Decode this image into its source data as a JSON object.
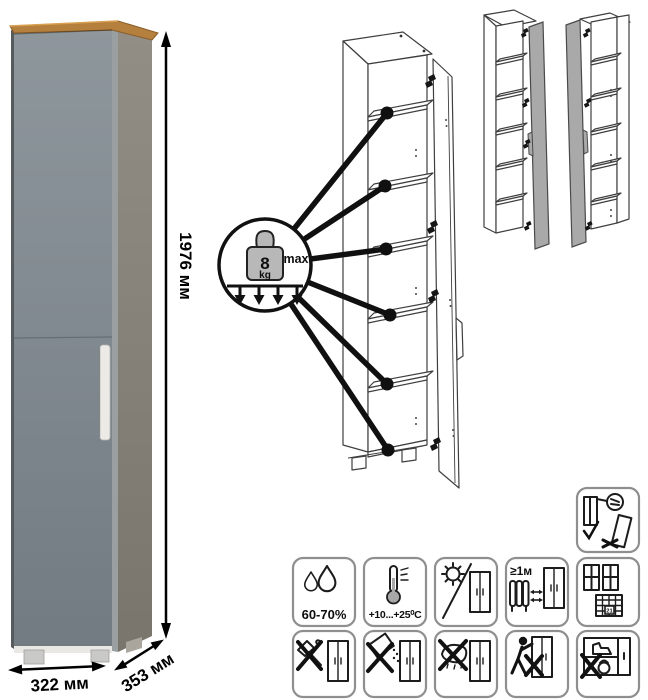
{
  "dimensions": {
    "height": "1976 мм",
    "width": "322 мм",
    "depth": "353 мм"
  },
  "shelf_load": {
    "value": "8",
    "unit": "kg",
    "qualifier": "max"
  },
  "care": {
    "humidity": "60-70%",
    "temperature": "+10...+25⁰C",
    "heater_distance": "≥1м",
    "calendar_day": "21"
  },
  "icons": {
    "top_right_icon": "secure-to-wall-icon",
    "row1": [
      "humidity-icon",
      "temperature-icon",
      "no-direct-sunlight-icon",
      "heater-distance-icon",
      "ventilation-calendar-icon"
    ],
    "row2": [
      "no-impact-icon",
      "no-spill-icon",
      "no-wet-cleaning-icon",
      "no-drag-icon",
      "no-overload-icon"
    ]
  },
  "colors": {
    "door_front": "#87919a",
    "side_panel": "#8a867e",
    "wood_top": "#b5803e",
    "handle": "#eceae6",
    "variant_door_shade": "#a9a9a9"
  }
}
